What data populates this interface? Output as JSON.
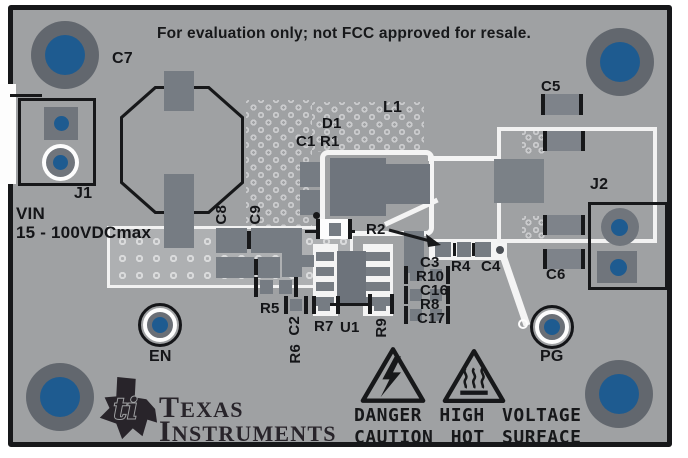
{
  "disclaimer": "For evaluation only; not FCC approved for resale.",
  "power_input": {
    "label": "VIN",
    "rating": "15 - 100VDCmax"
  },
  "connectors": {
    "j1": "J1",
    "j2": "J2"
  },
  "test_points": {
    "en": "EN",
    "pg": "PG"
  },
  "refdes": {
    "c1r1": "C1 R1",
    "c2": "C2",
    "c3": "C3",
    "c4": "C4",
    "c5": "C5",
    "c6": "C6",
    "c7": "C7",
    "c8": "C8",
    "c9": "C9",
    "c16": "C16",
    "c17": "C17",
    "d1": "D1",
    "l1": "L1",
    "r2": "R2",
    "r4": "R4",
    "r5": "R5",
    "r6": "R6",
    "r7": "R7",
    "r8": "R8",
    "r9": "R9",
    "r10": "R10",
    "u1": "U1"
  },
  "branding": {
    "name_line1": "Texas",
    "name_line2": "Instruments"
  },
  "warnings": {
    "line1": "DANGER HIGH VOLTAGE",
    "line2": "CAUTION HOT SURFACE"
  },
  "colors": {
    "board": "#9fa1a3",
    "silkscreen_white": "#f4f4f4",
    "silkscreen_black": "#17181a",
    "component_gray": "#767c83",
    "hole_ring": "#62676e",
    "hole_blue": "#1e5b90",
    "thermal_pad": "#aeb0b2",
    "logo_dark": "#28242a"
  }
}
